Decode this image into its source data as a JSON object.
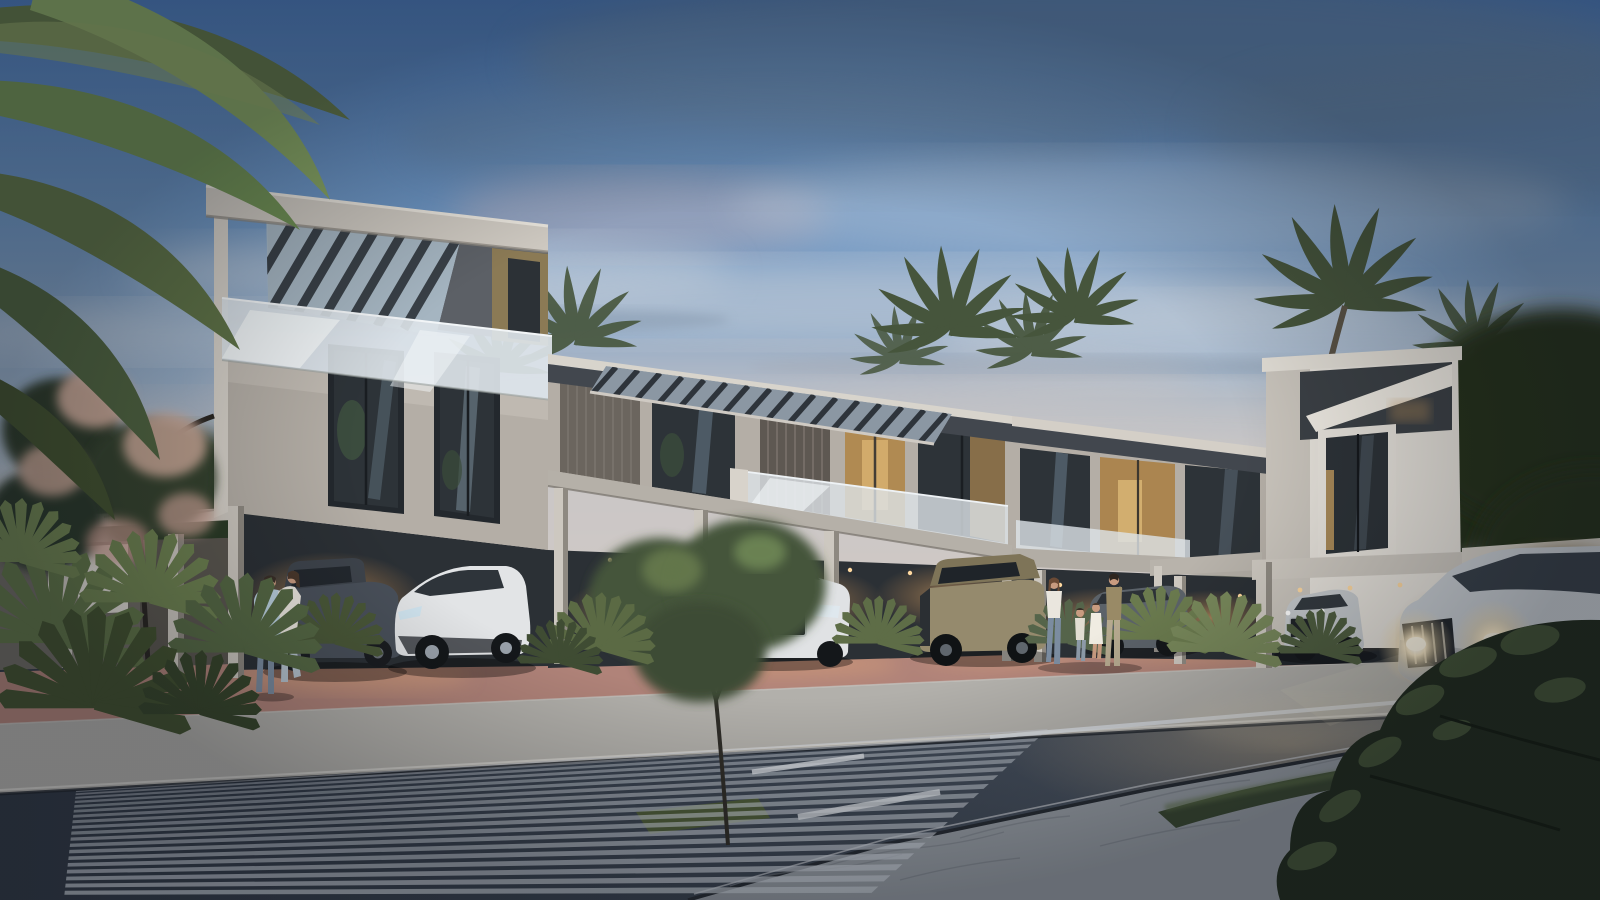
{
  "meta": {
    "title": "Dusk architectural rendering of a modern townhouse community street",
    "scene": "Contemporary flat-roofed townhouse row with rooftop pergolas, glass balustrades, lit carports with parked SUVs, residents on the sidewalk, palm trees, a zebra crosswalk and a silver SUV driving with headlights on",
    "time_of_day": "dusk",
    "style": "photorealistic 3D exterior visualization"
  },
  "colors": {
    "sky_top": "#4a77b4",
    "sky_upper": "#6d95c2",
    "sky_mid": "#93abc6",
    "sky_low": "#b3bfca",
    "sky_horizon": "#d3cac5",
    "cloud_dark": "#64809f",
    "cloud_light": "#c6cfd9",
    "cloud_pink": "#c9aeae",
    "wall_light": "#cdc8c0",
    "wall_mid": "#b4aea6",
    "wall_shade": "#8e8981",
    "wall_white": "#e6e2db",
    "fascia_dark": "#42474e",
    "recess_dark": "#2b3035",
    "panel_tan": "#8b7a55",
    "glass_dark": "#2d3338",
    "glass_reflect": "#6e8292",
    "balustrade_glass": "#dde4e9",
    "carport_glow": "#b98c5e",
    "paving_terracotta": "#b08379",
    "paving_lit": "#d9a27b",
    "sidewalk": "#b2b0ab",
    "curb_light": "#d8d6d1",
    "road_dark": "#333b48",
    "road_light": "#57616e",
    "crosswalk_stripe": "#c7cdd5",
    "marking_white": "#d7dbe0",
    "median_concrete": "#959ba2",
    "median_line": "#767c84",
    "hedge_green": "#394731",
    "foliage_dark": "#26331f",
    "foliage_mid": "#44543a",
    "foliage_highlight": "#7b9159",
    "palm_green": "#5f7347",
    "palm_bright": "#8fa465",
    "palm_distant": "#46553c",
    "blossom_pink": "#d4af9e",
    "autumn_warm": "#6f5c31",
    "trunk_dark": "#2f2d28",
    "headlight_core": "#fff8e6",
    "headlight_glow": "#f0d9a8",
    "car_white": "#e2e4e6",
    "car_dark_grey": "#49505a",
    "car_tan": "#958a6d",
    "car_grey": "#5b6269",
    "car_silver": "#c9ced3",
    "skin": "#c89b80",
    "outfit_blue": "#b9cfdd",
    "outfit_white": "#eae6de",
    "outfit_olive": "#998a66",
    "jeans_blue": "#7b8ca0"
  },
  "building": {
    "name": "modern townhouse row",
    "left_tower_stories": 3,
    "main_stories": 2,
    "features": [
      "rooftop pergola slats",
      "glass balustrades",
      "floor-to-ceiling windows",
      "warm interior lighting",
      "covered carports with downlights",
      "tan accent panel"
    ]
  },
  "vehicles": [
    {
      "name": "dark-grey-suv-parked",
      "color": "#49505a"
    },
    {
      "name": "white-crossover-parked",
      "color": "#e2e4e6"
    },
    {
      "name": "white-audi-suv-parked",
      "color": "#e0e2e4"
    },
    {
      "name": "tan-offroad-truck-parked",
      "color": "#958a6d"
    },
    {
      "name": "grey-suv-parked",
      "color": "#5b6269"
    },
    {
      "name": "silver-compact-suv-parked",
      "color": "#c6cacd"
    },
    {
      "name": "silver-suv-driving",
      "color": "#c9ced3",
      "state": "headlights on"
    }
  ],
  "people": [
    {
      "name": "embracing-couple",
      "location": "left carport driveway"
    },
    {
      "name": "family-of-four",
      "location": "center-right sidewalk"
    }
  ],
  "road": {
    "crosswalk": {
      "stripe_count": 19,
      "duty": 0.55,
      "perspective_ease": 1.3,
      "top": [
        [
          76,
          791
        ],
        [
          1048,
          729
        ]
      ],
      "bottom": [
        [
          64,
          898
        ],
        [
          866,
          898
        ]
      ]
    },
    "markings": [
      "white edge line",
      "two diagonal lane dashes"
    ]
  },
  "vegetation": [
    "overhanging palm fronds top-left",
    "fan palm cluster lower-left",
    "pink blossom tree",
    "round street tree",
    "background palm clusters",
    "dark trees behind right wing",
    "median hedge",
    "large foreground bush bottom-right"
  ]
}
